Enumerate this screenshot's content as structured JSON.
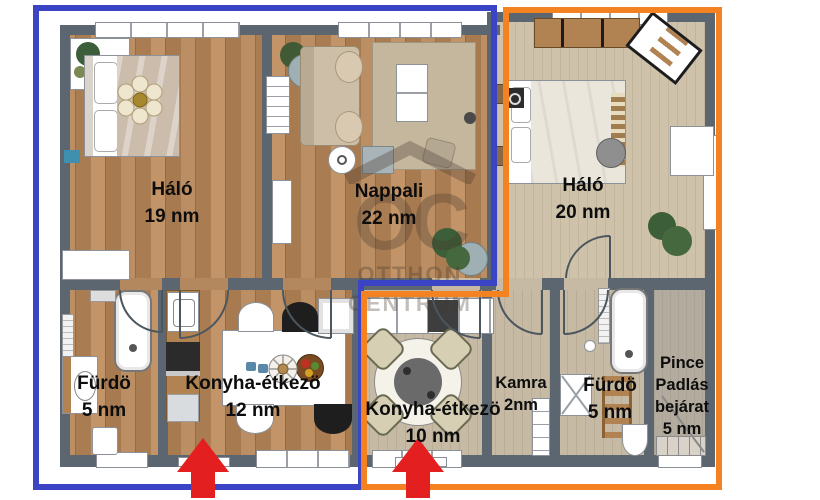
{
  "watermark": {
    "monogram": "OC",
    "line1": "OTTHON",
    "line2": "CENTRUM"
  },
  "rooms": {
    "halo19": {
      "name": "Háló",
      "area": "19 nm"
    },
    "nappali": {
      "name": "Nappali",
      "area": "22 nm"
    },
    "halo20": {
      "name": "Háló",
      "area": "20 nm"
    },
    "furdo_left": {
      "name": "Fürdö",
      "area": "5 nm"
    },
    "konyha12": {
      "name": "Konyha-étkezö",
      "area": "12 nm"
    },
    "konyha10": {
      "name": "Konyha-étkezö",
      "area": "10 nm"
    },
    "kamra": {
      "name": "Kamra",
      "area": "2nm"
    },
    "furdo_right": {
      "name": "Fürdö",
      "area": "5 nm"
    },
    "pince": {
      "name_line1": "Pince",
      "name_line2": "Padlás",
      "name_line3": "bejárat",
      "area": "5 nm"
    }
  },
  "colors": {
    "left_unit_outline": "#3a44c4",
    "right_unit_outline": "#f58220",
    "entrance_arrow": "#e41f1f",
    "wall": "#5b6670"
  },
  "entrances": {
    "count": 2,
    "symbol": "up-arrow"
  }
}
